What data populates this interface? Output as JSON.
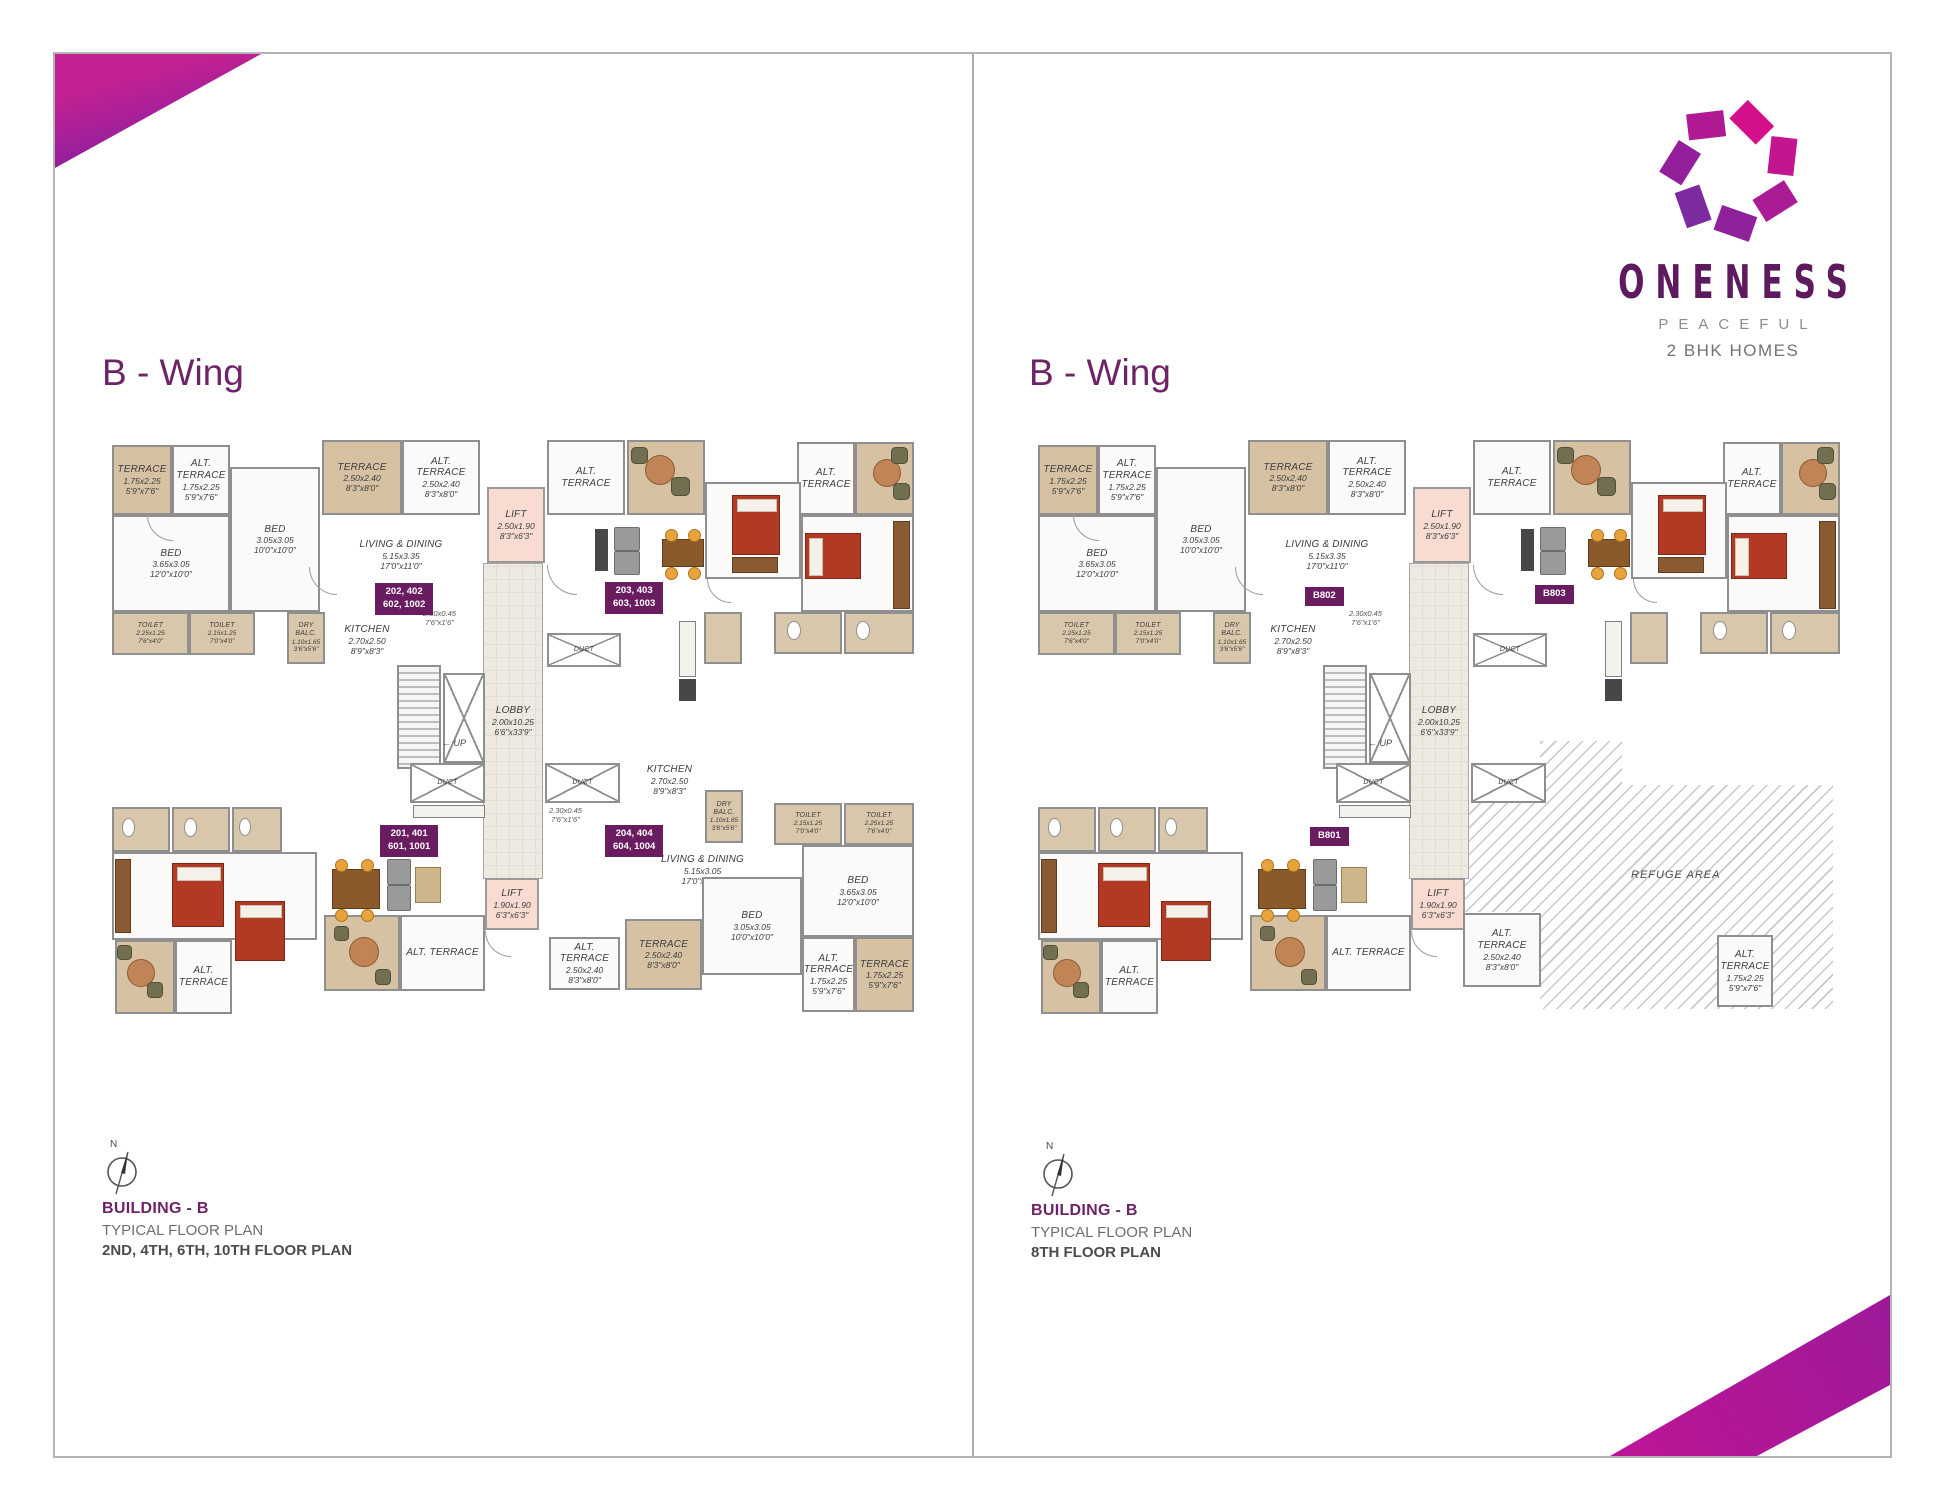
{
  "brand": {
    "name": "ONENESS",
    "tagline": "PEACEFUL",
    "subtitle": "2 BHK HOMES",
    "colors": {
      "accent_purple": "#6e2366",
      "badge_purple": "#6a1c61",
      "logo_pink": "#d4118d",
      "logo_violet": "#6d2a9d"
    }
  },
  "panels": [
    {
      "wing_title": "B - Wing",
      "compass_letter": "N",
      "building": "BUILDING - B",
      "plan_type": "TYPICAL FLOOR PLAN",
      "floors": "2ND, 4TH, 6TH, 10TH FLOOR PLAN",
      "variant": "left"
    },
    {
      "wing_title": "B - Wing",
      "compass_letter": "N",
      "building": "BUILDING - B",
      "plan_type": "TYPICAL FLOOR PLAN",
      "floors": "8TH FLOOR PLAN",
      "variant": "right"
    }
  ],
  "plan": {
    "size": {
      "w": 840,
      "h": 600
    },
    "rooms": [
      {
        "kind": "lobby",
        "label": "LOBBY",
        "dims": "2.00x10.25",
        "ft": "6'6\"x33'9\"",
        "x": 396,
        "y": 126,
        "w": 60,
        "h": 316
      },
      {
        "kind": "terrace",
        "label": "TERRACE",
        "dims": "1.75x2.25",
        "ft": "5'9\"x7'6\"",
        "x": 25,
        "y": 8,
        "w": 60,
        "h": 70
      },
      {
        "kind": "room",
        "label": "ALT. TERRACE",
        "dims": "1.75x2.25",
        "ft": "5'9\"x7'6\"",
        "x": 85,
        "y": 8,
        "w": 58,
        "h": 70
      },
      {
        "kind": "room",
        "label": "BED",
        "dims": "3.65x3.05",
        "ft": "12'0\"x10'0\"",
        "x": 25,
        "y": 78,
        "w": 118,
        "h": 97
      },
      {
        "kind": "wet",
        "label": "TOILET",
        "dims": "2.25x1.25",
        "ft": "7'6\"x4'0\"",
        "x": 25,
        "y": 175,
        "w": 77,
        "h": 43
      },
      {
        "kind": "wet",
        "label": "TOILET",
        "dims": "2.15x1.25",
        "ft": "7'0\"x4'0\"",
        "x": 102,
        "y": 175,
        "w": 66,
        "h": 43
      },
      {
        "kind": "room",
        "label": "BED",
        "dims": "3.05x3.05",
        "ft": "10'0\"x10'0\"",
        "x": 143,
        "y": 30,
        "w": 90,
        "h": 145
      },
      {
        "kind": "wet",
        "label": "DRY BALC.",
        "dims": "1.10x1.65",
        "ft": "3'6\"x5'6\"",
        "x": 200,
        "y": 175,
        "w": 38,
        "h": 52
      },
      {
        "kind": "open",
        "label": "KITCHEN",
        "dims": "2.70x2.50",
        "ft": "8'9\"x8'3\"",
        "x": 238,
        "y": 162,
        "w": 84,
        "h": 82
      },
      {
        "kind": "terrace",
        "label": "TERRACE",
        "dims": "2.50x2.40",
        "ft": "8'3\"x8'0\"",
        "x": 235,
        "y": 3,
        "w": 80,
        "h": 75
      },
      {
        "kind": "room",
        "label": "ALT. TERRACE",
        "dims": "2.50x2.40",
        "ft": "8'3\"x8'0\"",
        "x": 315,
        "y": 3,
        "w": 78,
        "h": 75
      },
      {
        "kind": "open",
        "label": "LIVING & DINING",
        "dims": "5.15x3.35",
        "ft": "17'0\"x11'0\"",
        "x": 233,
        "y": 78,
        "w": 162,
        "h": 80
      },
      {
        "kind": "lift",
        "label": "LIFT",
        "dims": "2.50x1.90",
        "ft": "8'3\"x6'3\"",
        "x": 400,
        "y": 50,
        "w": 58,
        "h": 76
      },
      {
        "kind": "room",
        "label": "ALT. TERRACE",
        "x": 460,
        "y": 3,
        "w": 78,
        "h": 75
      },
      {
        "kind": "duct",
        "label": "DUCT",
        "x": 460,
        "y": 196,
        "w": 74,
        "h": 34
      },
      {
        "kind": "stairs",
        "x": 310,
        "y": 228,
        "w": 44,
        "h": 104
      },
      {
        "kind": "xbox",
        "x": 356,
        "y": 236,
        "w": 42,
        "h": 90
      },
      {
        "kind": "duct",
        "label": "DUCT",
        "x": 323,
        "y": 326,
        "w": 75,
        "h": 40
      },
      {
        "kind": "duct",
        "label": "DUCT",
        "x": 458,
        "y": 326,
        "w": 75,
        "h": 40
      },
      {
        "kind": "lift",
        "label": "LIFT",
        "dims": "1.90x1.90",
        "ft": "6'3\"x6'3\"",
        "x": 398,
        "y": 441,
        "w": 54,
        "h": 52
      },
      {
        "kind": "terrace",
        "x": 540,
        "y": 3,
        "w": 78,
        "h": 75
      },
      {
        "kind": "room",
        "label": "ALT. TERRACE",
        "x": 710,
        "y": 5,
        "w": 58,
        "h": 73
      },
      {
        "kind": "terrace",
        "x": 768,
        "y": 5,
        "w": 59,
        "h": 73
      },
      {
        "kind": "room",
        "x": 618,
        "y": 45,
        "w": 96,
        "h": 97
      },
      {
        "kind": "room",
        "x": 714,
        "y": 78,
        "w": 113,
        "h": 97
      },
      {
        "kind": "wet",
        "x": 687,
        "y": 175,
        "w": 68,
        "h": 42
      },
      {
        "kind": "wet",
        "x": 757,
        "y": 175,
        "w": 70,
        "h": 42
      },
      {
        "kind": "wet",
        "x": 617,
        "y": 175,
        "w": 38,
        "h": 52
      },
      {
        "kind": "wet",
        "x": 25,
        "y": 370,
        "w": 58,
        "h": 45
      },
      {
        "kind": "wet",
        "x": 85,
        "y": 370,
        "w": 58,
        "h": 45
      },
      {
        "kind": "wet",
        "x": 145,
        "y": 370,
        "w": 50,
        "h": 45
      },
      {
        "kind": "room",
        "x": 25,
        "y": 415,
        "w": 205,
        "h": 88
      },
      {
        "kind": "terrace",
        "x": 28,
        "y": 503,
        "w": 60,
        "h": 74
      },
      {
        "kind": "room",
        "label": "ALT. TERRACE",
        "x": 88,
        "y": 503,
        "w": 57,
        "h": 74
      },
      {
        "kind": "terrace",
        "x": 237,
        "y": 478,
        "w": 76,
        "h": 76
      },
      {
        "kind": "room",
        "label": "ALT. TERRACE",
        "x": 313,
        "y": 478,
        "w": 85,
        "h": 76
      }
    ],
    "minidims": [
      {
        "l1": "2.30x0.45",
        "l2": "7'6\"x1'6\"",
        "x": 336,
        "y": 172
      }
    ],
    "up_label": {
      "text": "← UP",
      "x": 355,
      "y": 301
    },
    "furniture": [
      {
        "k": "rtable",
        "x": 558,
        "y": 18,
        "w": 28,
        "h": 28
      },
      {
        "k": "chair",
        "x": 544,
        "y": 10,
        "w": 15,
        "h": 15
      },
      {
        "k": "chair",
        "x": 584,
        "y": 40,
        "w": 17,
        "h": 17
      },
      {
        "k": "sofa",
        "x": 527,
        "y": 90,
        "w": 24,
        "h": 22
      },
      {
        "k": "sofa",
        "x": 527,
        "y": 114,
        "w": 24,
        "h": 22
      },
      {
        "k": "dark",
        "x": 508,
        "y": 92,
        "w": 13,
        "h": 42
      },
      {
        "k": "dtable",
        "x": 575,
        "y": 102,
        "w": 40,
        "h": 26
      },
      {
        "k": "stool",
        "x": 578,
        "y": 92,
        "w": 11,
        "h": 11
      },
      {
        "k": "stool",
        "x": 601,
        "y": 92,
        "w": 11,
        "h": 11
      },
      {
        "k": "stool",
        "x": 578,
        "y": 130,
        "w": 11,
        "h": 11
      },
      {
        "k": "stool",
        "x": 601,
        "y": 130,
        "w": 11,
        "h": 11
      },
      {
        "k": "bedv",
        "x": 645,
        "y": 58,
        "w": 46,
        "h": 58
      },
      {
        "k": "ward",
        "x": 645,
        "y": 120,
        "w": 44,
        "h": 14
      },
      {
        "k": "bedh",
        "x": 718,
        "y": 96,
        "w": 54,
        "h": 44
      },
      {
        "k": "wardv",
        "x": 806,
        "y": 84,
        "w": 15,
        "h": 86
      },
      {
        "k": "rtable",
        "x": 786,
        "y": 22,
        "w": 26,
        "h": 26
      },
      {
        "k": "chair",
        "x": 804,
        "y": 10,
        "w": 15,
        "h": 15
      },
      {
        "k": "chair",
        "x": 806,
        "y": 46,
        "w": 15,
        "h": 15
      },
      {
        "k": "counter",
        "x": 592,
        "y": 184,
        "w": 17,
        "h": 56
      },
      {
        "k": "dark",
        "x": 592,
        "y": 242,
        "w": 17,
        "h": 22
      },
      {
        "k": "fix",
        "x": 700,
        "y": 184,
        "w": 14,
        "h": 19
      },
      {
        "k": "fix",
        "x": 769,
        "y": 184,
        "w": 14,
        "h": 19
      },
      {
        "k": "bedv",
        "x": 85,
        "y": 426,
        "w": 50,
        "h": 62
      },
      {
        "k": "bedv",
        "x": 148,
        "y": 464,
        "w": 48,
        "h": 58
      },
      {
        "k": "wardv",
        "x": 28,
        "y": 422,
        "w": 14,
        "h": 72
      },
      {
        "k": "dtable",
        "x": 245,
        "y": 432,
        "w": 46,
        "h": 38
      },
      {
        "k": "stool",
        "x": 248,
        "y": 422,
        "w": 11,
        "h": 11
      },
      {
        "k": "stool",
        "x": 274,
        "y": 422,
        "w": 11,
        "h": 11
      },
      {
        "k": "stool",
        "x": 248,
        "y": 472,
        "w": 11,
        "h": 11
      },
      {
        "k": "stool",
        "x": 274,
        "y": 472,
        "w": 11,
        "h": 11
      },
      {
        "k": "sofa",
        "x": 300,
        "y": 422,
        "w": 22,
        "h": 24
      },
      {
        "k": "sofa",
        "x": 300,
        "y": 448,
        "w": 22,
        "h": 24
      },
      {
        "k": "ctable",
        "x": 328,
        "y": 430,
        "w": 24,
        "h": 34
      },
      {
        "k": "rtable",
        "x": 40,
        "y": 522,
        "w": 26,
        "h": 26
      },
      {
        "k": "chair",
        "x": 30,
        "y": 508,
        "w": 13,
        "h": 13
      },
      {
        "k": "chair",
        "x": 60,
        "y": 545,
        "w": 14,
        "h": 14
      },
      {
        "k": "rtable",
        "x": 262,
        "y": 500,
        "w": 28,
        "h": 28
      },
      {
        "k": "chair",
        "x": 247,
        "y": 489,
        "w": 13,
        "h": 13
      },
      {
        "k": "chair",
        "x": 288,
        "y": 532,
        "w": 14,
        "h": 14
      },
      {
        "k": "counter",
        "x": 326,
        "y": 368,
        "w": 72,
        "h": 13
      },
      {
        "k": "fix",
        "x": 35,
        "y": 381,
        "w": 13,
        "h": 19
      },
      {
        "k": "fix",
        "x": 97,
        "y": 381,
        "w": 13,
        "h": 19
      },
      {
        "k": "fix",
        "x": 152,
        "y": 381,
        "w": 12,
        "h": 18
      },
      {
        "k": "arc",
        "x": 60,
        "y": 78,
        "w": 26,
        "h": 26
      },
      {
        "k": "arc",
        "x": 460,
        "y": 128,
        "w": 30,
        "h": 30
      },
      {
        "k": "arc",
        "x": 222,
        "y": 130,
        "w": 28,
        "h": 28
      },
      {
        "k": "arc",
        "x": 398,
        "y": 494,
        "w": 26,
        "h": 26
      },
      {
        "k": "arc",
        "x": 620,
        "y": 142,
        "w": 24,
        "h": 24
      }
    ],
    "variants": {
      "left": {
        "rooms": [
          {
            "kind": "open",
            "label": "KITCHEN",
            "dims": "2.70x2.50",
            "ft": "8'9\"x8'3\"",
            "x": 540,
            "y": 306,
            "w": 85,
            "h": 74
          },
          {
            "kind": "open",
            "label": "LIVING & DINING",
            "dims": "5.15x3.05",
            "ft": "17'0\"x10'0\"",
            "x": 533,
            "y": 392,
            "w": 165,
            "h": 82
          },
          {
            "kind": "wet",
            "label": "DRY BALC.",
            "dims": "1.10x1.65",
            "ft": "3'6\"x5'6\"",
            "x": 618,
            "y": 353,
            "w": 38,
            "h": 53
          },
          {
            "kind": "wet",
            "label": "TOILET",
            "dims": "2.15x1.25",
            "ft": "7'0\"x4'0\"",
            "x": 687,
            "y": 366,
            "w": 68,
            "h": 42
          },
          {
            "kind": "wet",
            "label": "TOILET",
            "dims": "2.25x1.25",
            "ft": "7'6\"x4'0\"",
            "x": 757,
            "y": 366,
            "w": 70,
            "h": 42
          },
          {
            "kind": "room",
            "label": "BED",
            "dims": "3.05x3.05",
            "ft": "10'0\"x10'0\"",
            "x": 615,
            "y": 440,
            "w": 100,
            "h": 98
          },
          {
            "kind": "room",
            "label": "BED",
            "dims": "3.65x3.05",
            "ft": "12'0\"x10'0\"",
            "x": 715,
            "y": 408,
            "w": 112,
            "h": 92
          },
          {
            "kind": "room",
            "label": "ALT. TERRACE",
            "dims": "2.50x2.40",
            "ft": "8'3\"x8'0\"",
            "x": 462,
            "y": 500,
            "w": 71,
            "h": 53
          },
          {
            "kind": "terrace",
            "label": "TERRACE",
            "dims": "2.50x2.40",
            "ft": "8'3\"x8'0\"",
            "x": 538,
            "y": 482,
            "w": 77,
            "h": 71
          },
          {
            "kind": "room",
            "label": "ALT. TERRACE",
            "dims": "1.75x2.25",
            "ft": "5'9\"x7'6\"",
            "x": 715,
            "y": 500,
            "w": 53,
            "h": 75
          },
          {
            "kind": "terrace",
            "label": "TERRACE",
            "dims": "1.75x2.25",
            "ft": "5'9\"x7'6\"",
            "x": 768,
            "y": 500,
            "w": 59,
            "h": 75
          }
        ],
        "badges": [
          {
            "lines": [
              "202, 402",
              "602, 1002"
            ],
            "x": 288,
            "y": 146
          },
          {
            "lines": [
              "203, 403",
              "603, 1003"
            ],
            "x": 518,
            "y": 145
          },
          {
            "lines": [
              "201, 401",
              "601, 1001"
            ],
            "x": 293,
            "y": 388
          },
          {
            "lines": [
              "204, 404",
              "604, 1004"
            ],
            "x": 518,
            "y": 388
          }
        ],
        "minidims": [
          {
            "l1": "2.30x0.45",
            "l2": "7'6\"x1'6\"",
            "x": 462,
            "y": 369
          }
        ]
      },
      "right": {
        "refuge": {
          "label": "REFUGE AREA",
          "x": 450,
          "y": 304,
          "w": 370,
          "h": 268,
          "poly": "77px 0,159px 0,159px 44px,370px 44px,370px 268px,77px 268px,77px 171px,0 171px,0 61px,77px 61px",
          "label_x": 168,
          "label_y": 128
        },
        "rooms": [
          {
            "kind": "room",
            "label": "ALT. TERRACE",
            "dims": "2.50x2.40",
            "ft": "8'3\"x8'0\"",
            "x": 450,
            "y": 476,
            "w": 78,
            "h": 74
          },
          {
            "kind": "room",
            "label": "ALT. TERRACE",
            "dims": "1.75x2.25",
            "ft": "5'9\"x7'6\"",
            "x": 704,
            "y": 498,
            "w": 56,
            "h": 72
          }
        ],
        "badges": [
          {
            "lines": [
              "B802"
            ],
            "x": 292,
            "y": 150
          },
          {
            "lines": [
              "B803"
            ],
            "x": 522,
            "y": 148
          },
          {
            "lines": [
              "B801"
            ],
            "x": 297,
            "y": 390
          }
        ],
        "minidims": []
      }
    }
  }
}
